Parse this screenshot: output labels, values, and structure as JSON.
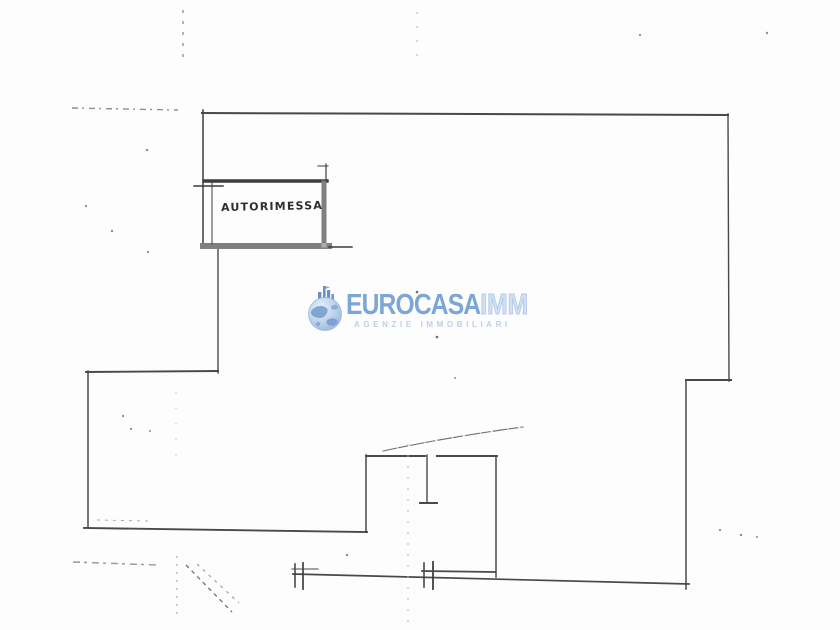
{
  "plan": {
    "room_label": "AUTORIMESSA"
  },
  "watermark": {
    "brand_primary": "EUROCASA",
    "brand_secondary": "IMM",
    "tagline": "AGENZIE IMMOBILIARI",
    "colors": {
      "brand_blue": "#6f9dd2",
      "brand_mid_blue": "#a9c4e6",
      "brand_light_blue": "#cddef2",
      "tagline_blue": "#b4cbe8",
      "globe_light": "#b8d0ea",
      "globe_dark": "#6d96cb",
      "ink": "#333333"
    }
  }
}
